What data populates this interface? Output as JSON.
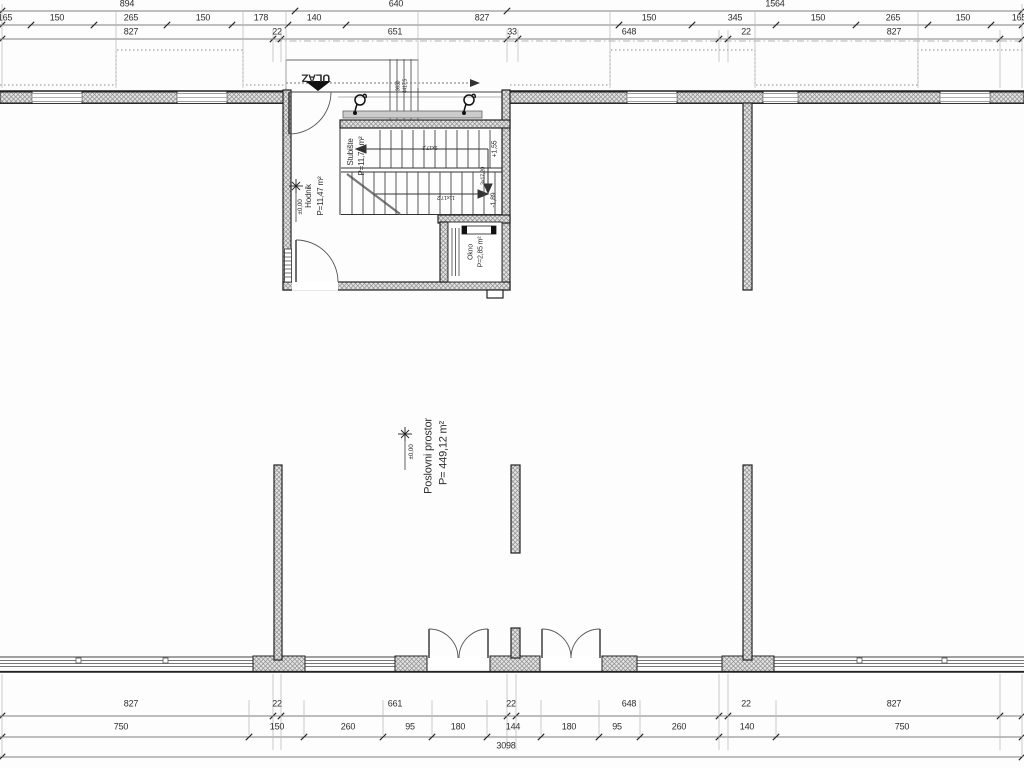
{
  "drawing": {
    "type": "architectural-floor-plan",
    "unit": "cm",
    "colors": {
      "line": "#222222",
      "dim_text": "#2d2d2d",
      "wall_hatch": "#8d8d8d",
      "wall_fill": "#e3e3e3",
      "landing_fill": "#cbcbcb",
      "guide": "#999999"
    }
  },
  "dimensions": {
    "rows": [
      {
        "name": "top-overall",
        "y": 4,
        "values": [
          {
            "t": "894",
            "x": 127
          },
          {
            "t": "640",
            "x": 396
          },
          {
            "t": "1564",
            "x": 775
          }
        ]
      },
      {
        "name": "top-detail",
        "y": 18,
        "values": [
          {
            "t": "165",
            "x": 5
          },
          {
            "t": "150",
            "x": 57
          },
          {
            "t": "265",
            "x": 131
          },
          {
            "t": "150",
            "x": 203
          },
          {
            "t": "178",
            "x": 261
          },
          {
            "t": "140",
            "x": 314
          },
          {
            "t": "827",
            "x": 482
          },
          {
            "t": "150",
            "x": 649
          },
          {
            "t": "345",
            "x": 735
          },
          {
            "t": "150",
            "x": 818
          },
          {
            "t": "265",
            "x": 893
          },
          {
            "t": "150",
            "x": 963
          },
          {
            "t": "165",
            "x": 1019
          }
        ]
      },
      {
        "name": "top-inner",
        "y": 32,
        "values": [
          {
            "t": "827",
            "x": 131
          },
          {
            "t": "22",
            "x": 277
          },
          {
            "t": "651",
            "x": 395
          },
          {
            "t": "33",
            "x": 512
          },
          {
            "t": "648",
            "x": 629
          },
          {
            "t": "22",
            "x": 746
          },
          {
            "t": "827",
            "x": 894
          }
        ]
      },
      {
        "name": "bottom-inner",
        "y": 704,
        "values": [
          {
            "t": "827",
            "x": 131
          },
          {
            "t": "22",
            "x": 277
          },
          {
            "t": "661",
            "x": 395
          },
          {
            "t": "22",
            "x": 511
          },
          {
            "t": "648",
            "x": 629
          },
          {
            "t": "22",
            "x": 746
          },
          {
            "t": "827",
            "x": 894
          }
        ]
      },
      {
        "name": "bottom-detail",
        "y": 727,
        "values": [
          {
            "t": "750",
            "x": 121
          },
          {
            "t": "150",
            "x": 277
          },
          {
            "t": "260",
            "x": 348
          },
          {
            "t": "95",
            "x": 410
          },
          {
            "t": "180",
            "x": 458
          },
          {
            "t": "144",
            "x": 513
          },
          {
            "t": "180",
            "x": 569
          },
          {
            "t": "95",
            "x": 617
          },
          {
            "t": "260",
            "x": 679
          },
          {
            "t": "140",
            "x": 747
          },
          {
            "t": "750",
            "x": 902
          }
        ]
      },
      {
        "name": "bottom-overall",
        "y": 746,
        "values": [
          {
            "t": "3098",
            "x": 506
          }
        ]
      }
    ]
  },
  "annotations": [
    {
      "id": "entrance-label",
      "t": "ULAZ",
      "x": 316,
      "y": 77,
      "r": 180,
      "s": 11,
      "b": 1
    },
    {
      "id": "room-stubiste-name",
      "t": "Stubište",
      "x": 351,
      "y": 152,
      "r": -90,
      "s": 8
    },
    {
      "id": "room-stubiste-area",
      "t": "P=11,71 m²",
      "x": 362,
      "y": 156,
      "r": -90,
      "s": 8
    },
    {
      "id": "room-hodnik-name",
      "t": "Hodnik",
      "x": 309,
      "y": 196,
      "r": -90,
      "s": 8
    },
    {
      "id": "room-hodnik-area",
      "t": "P=11,47 m²",
      "x": 321,
      "y": 196,
      "r": -90,
      "s": 8
    },
    {
      "id": "room-okno-name",
      "t": "Okno",
      "x": 471,
      "y": 252,
      "r": -90,
      "s": 7
    },
    {
      "id": "room-okno-area",
      "t": "P=2,85 m²",
      "x": 481,
      "y": 252,
      "r": -90,
      "s": 7
    },
    {
      "id": "room-poslovni-name",
      "t": "Poslovni prostor",
      "x": 429,
      "y": 456,
      "r": -90,
      "s": 11
    },
    {
      "id": "room-poslovni-area",
      "t": "P= 449,12 m²",
      "x": 444,
      "y": 453,
      "r": -90,
      "s": 11
    },
    {
      "id": "level-hodnik",
      "t": "±0,00",
      "x": 301,
      "y": 207,
      "r": -90,
      "s": 6.5
    },
    {
      "id": "level-hall",
      "t": "±0,00",
      "x": 412,
      "y": 452,
      "r": -90,
      "s": 6.5
    },
    {
      "id": "level-plus-155",
      "t": "+1,55",
      "x": 495,
      "y": 149,
      "r": -90,
      "s": 7
    },
    {
      "id": "level-minus-189",
      "t": "-1,89",
      "x": 494,
      "y": 200,
      "r": -90,
      "s": 7
    },
    {
      "id": "stair-riser-note",
      "t": "3x17,20",
      "x": 484,
      "y": 176,
      "r": -90,
      "s": 5.5
    },
    {
      "id": "stair-run-upper-note",
      "t": "9x17,2",
      "x": 430,
      "y": 146,
      "r": 180,
      "s": 5.5
    },
    {
      "id": "stair-run-lower-note",
      "t": "11x17,2",
      "x": 446,
      "y": 196,
      "r": 180,
      "s": 5.5
    },
    {
      "id": "stair-width-note-1",
      "t": "3630",
      "x": 399,
      "y": 86,
      "r": -90,
      "s": 5
    },
    {
      "id": "stair-width-note-2",
      "t": "4417,5",
      "x": 406,
      "y": 86,
      "r": -90,
      "s": 5
    }
  ]
}
